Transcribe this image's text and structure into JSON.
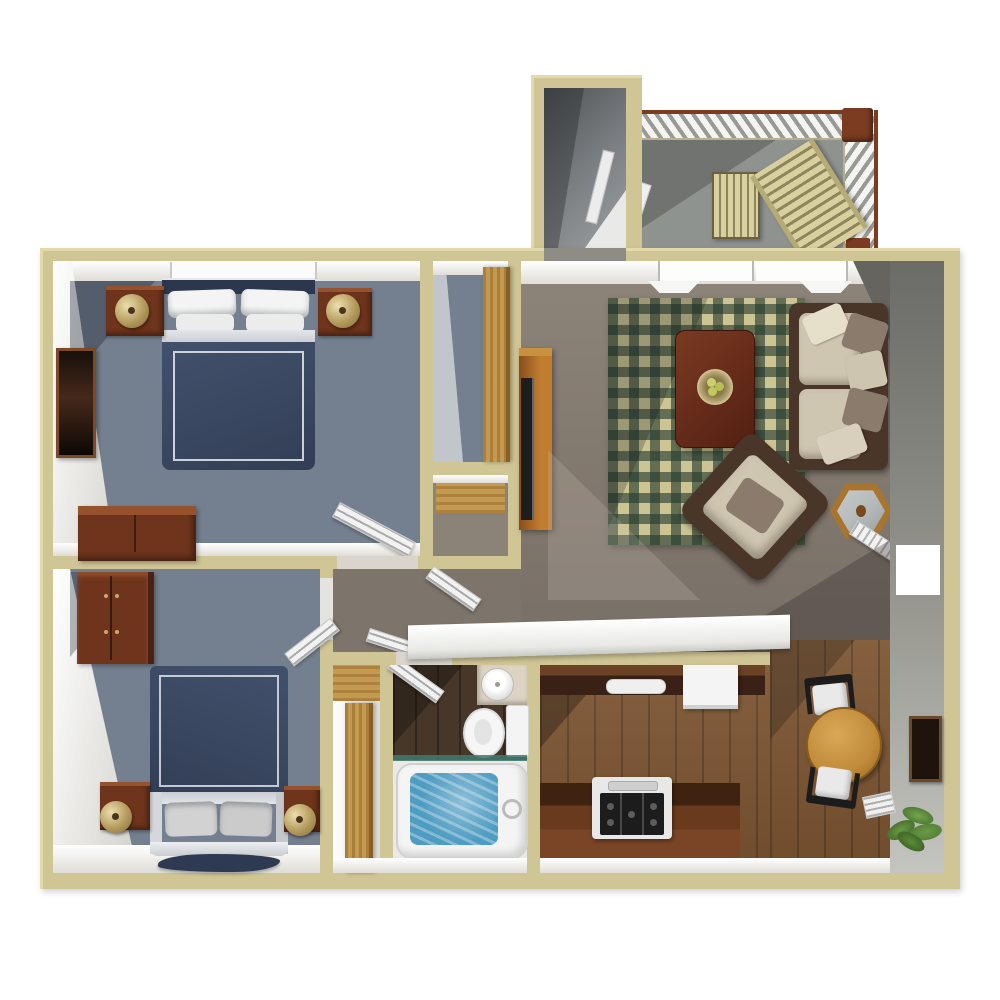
{
  "scene": {
    "type": "3d-rendered-apartment-floor-plan",
    "background": "#ffffff",
    "visible_text": []
  },
  "palette": {
    "wall": "#cfc595",
    "walledge": "#e3daab",
    "carpetbed": "#74808f",
    "carpethall": "#7d746b",
    "carpetliving": "#837a70",
    "rugbase": "#ccc493",
    "rugcheck": "rgba(36,58,46,0.62)",
    "navy": "#3a4760",
    "navydark": "#2c374e",
    "silver": "#c9cdd2",
    "pillow": "#f4f4f4",
    "wooddark": "#6f341c",
    "woodtop": "#95522c",
    "woodlight": "#c49a50",
    "woodtable": "#c08b3a",
    "woodcoffee": "#5a241a",
    "counterdark": "#3a2115",
    "countermid": "#6b4226",
    "counterface": "#7a4526",
    "kitchenfloor": "#7d5633",
    "bathfloor": "#463729",
    "water": "#4f9cc2",
    "teal": "#3f7a70",
    "brass": "#b49a5c",
    "sofaframe": "#4a3529",
    "cushion": "#cfc6b2",
    "taupe": "#8b7b6d",
    "balconyfloor": "#8f938f",
    "rail": "#7c3c22",
    "slat": "#d9d0a0",
    "slatgap": "#8f855c",
    "glass": "#b2b8b8",
    "plant": "#4e7a33",
    "chairblack": "#1c1c1c",
    "grayface1": "#6b6b67",
    "grayface2": "#c4c4c0"
  },
  "rooms": [
    {
      "id": "entry-stairwell",
      "items": [
        "stairwell-door-leaf",
        "stairwell-landing"
      ]
    },
    {
      "id": "balcony",
      "items": [
        "railing-top",
        "railing-right",
        "corner-post",
        "slat-table",
        "lounge-chair",
        "balcony-door-leaf"
      ]
    },
    {
      "id": "bedroom-1",
      "items": [
        "double-bed",
        "pillows",
        "nightstand-left",
        "nightstand-right",
        "brass-lamp-left",
        "brass-lamp-right",
        "wall-picture",
        "dresser",
        "louvered-door",
        "window"
      ]
    },
    {
      "id": "closet-walkin",
      "items": [
        "wood-door"
      ]
    },
    {
      "id": "closet-linen",
      "items": [
        "wood-floor"
      ]
    },
    {
      "id": "hallway",
      "items": [
        "louvered-door-1",
        "louvered-door-2"
      ]
    },
    {
      "id": "bedroom-2",
      "items": [
        "double-bed",
        "pillows",
        "bedside-rug",
        "armoire",
        "nightstand-left",
        "nightstand-right",
        "brass-lamp-left",
        "brass-lamp-right",
        "louvered-door"
      ]
    },
    {
      "id": "hall-closet",
      "items": [
        "wood-door"
      ]
    },
    {
      "id": "bathroom",
      "items": [
        "sink-counter",
        "round-basin",
        "toilet",
        "bathtub",
        "bath-door-leaf",
        "glass-shelf"
      ]
    },
    {
      "id": "kitchen",
      "items": [
        "upper-counter",
        "kitchen-sink",
        "refrigerator",
        "lower-counter",
        "stove",
        "breakfast-bar"
      ]
    },
    {
      "id": "dining-area",
      "items": [
        "round-table",
        "chair-top",
        "chair-bottom",
        "potted-plant",
        "wall-art",
        "floor-vent"
      ]
    },
    {
      "id": "living-room",
      "items": [
        "windows",
        "plaid-rug",
        "coffee-table",
        "fruit-bowl",
        "sofa",
        "armchair",
        "hex-side-table",
        "tv-cabinet",
        "entry-door-leaf"
      ]
    }
  ]
}
